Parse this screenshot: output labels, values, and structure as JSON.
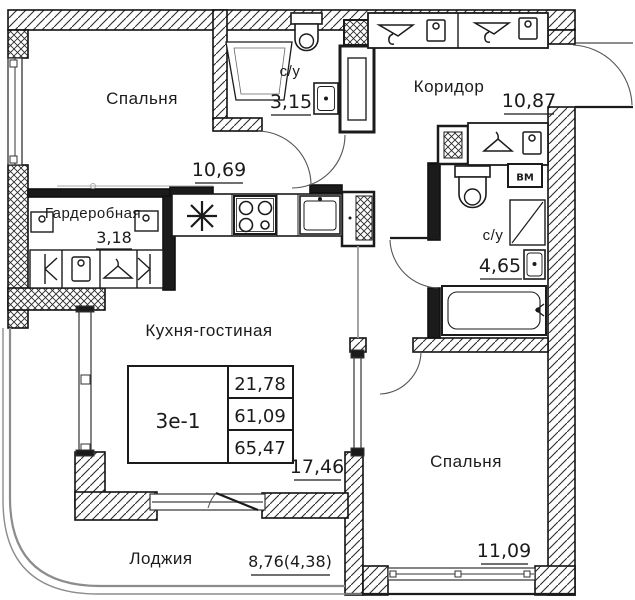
{
  "meta": {
    "kind": "apartment-floor-plan"
  },
  "unit": {
    "id": "3е-1",
    "rows": [
      "21,78",
      "61,09",
      "65,47"
    ]
  },
  "rooms": {
    "bedroom1": {
      "name": "Спальня",
      "area": "10,69"
    },
    "bath1": {
      "name": "с/у",
      "area": "3,15"
    },
    "corridor": {
      "name": "Коридор",
      "area": "10,87"
    },
    "wardrobe": {
      "name": "Гардеробная",
      "area": "3,18"
    },
    "bath2": {
      "name": "с/у",
      "area": "4,65"
    },
    "kitchen": {
      "name": "Кухня-гостиная",
      "area": "17,46"
    },
    "bedroom2": {
      "name": "Спальня",
      "area": "11,09"
    },
    "loggia": {
      "name": "Лоджия",
      "area": "8,76(4,38)"
    }
  },
  "labels": {
    "washer": "ВМ"
  },
  "colors": {
    "line": "#1b1b1b",
    "glazing": "#8c8c8c",
    "background": "#ffffff"
  }
}
